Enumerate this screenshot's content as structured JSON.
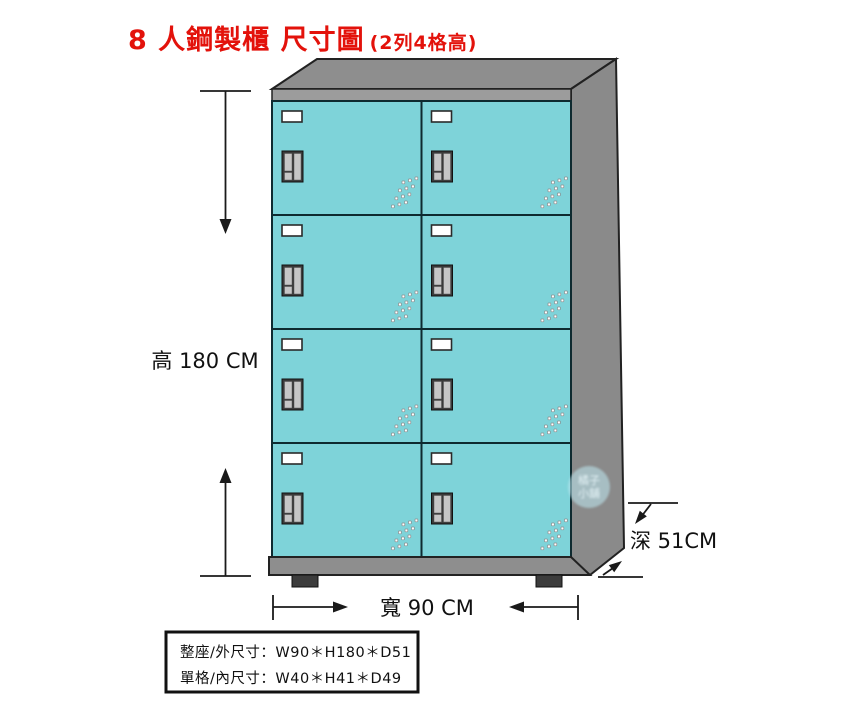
{
  "title": {
    "main": "8 人鋼製櫃 尺寸圖",
    "suffix": "(2列4格高)",
    "color": "#e3120b"
  },
  "cabinet": {
    "type": "steel-locker",
    "columns": 2,
    "rows": 4,
    "door_count": 8
  },
  "dimensions": {
    "height": "高 180 CM",
    "width": "寬 90 CM",
    "depth": "深 51CM"
  },
  "info_box": {
    "line1": "整座/外尺寸：W90＊H180＊D51",
    "line2": "單格/內尺寸：W40＊H41＊D49"
  },
  "watermark": {
    "line1": "橘子",
    "line2": "小舖"
  },
  "colors": {
    "door_fill": "#7ed3d9",
    "slot_fill": "#ffffff",
    "handle_fill": "#c6c6c6",
    "handle_frame": "#3a3a3a",
    "cabinet_top": "#8e8e8e",
    "cabinet_side": "#8a8a8a",
    "cabinet_base": "#8e8e8e",
    "foot": "#3c3c3c",
    "dimension": "#1a1a1a"
  }
}
